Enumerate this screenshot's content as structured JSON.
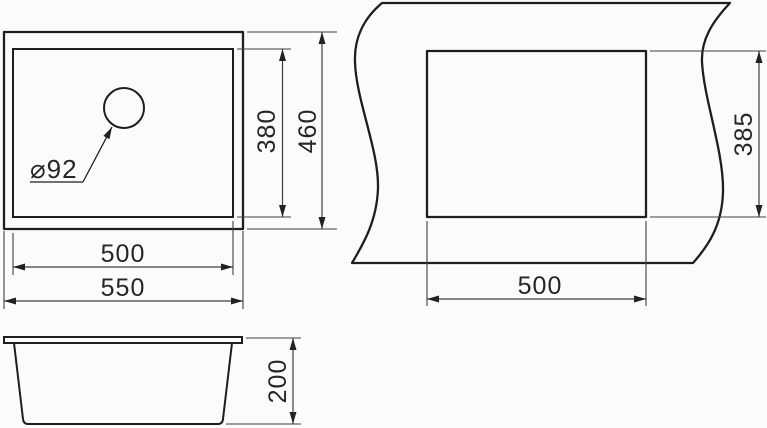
{
  "top_view": {
    "inner_width": "500",
    "outer_width": "550",
    "inner_height": "380",
    "outer_height": "460",
    "drain_diameter": "⌀92"
  },
  "cutout_view": {
    "width": "500",
    "height": "385"
  },
  "side_view": {
    "height": "200"
  },
  "colors": {
    "outline": "#1e1e1e",
    "dimension": "#3f3f3f",
    "text": "#262626",
    "background": "#fbfbfb"
  }
}
